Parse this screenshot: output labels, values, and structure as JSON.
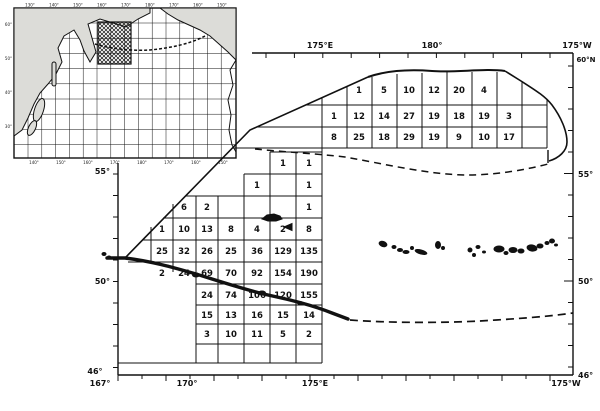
{
  "figure": {
    "kind": "survey-grid-map",
    "region_note": "",
    "colors": {
      "ink": "#111111",
      "paper": "#ffffff",
      "land_fill": "#dcdcd8"
    }
  },
  "axes": {
    "top_labels": [
      {
        "text": "175°E",
        "x": 320
      },
      {
        "text": "180°",
        "x": 432
      },
      {
        "text": "175°W",
        "x": 577
      }
    ],
    "corner_label": {
      "text": "60°N",
      "x": 586,
      "y": 62
    },
    "right_labels": [
      {
        "text": "55°",
        "y": 177
      },
      {
        "text": "50°",
        "y": 284
      },
      {
        "text": "46°",
        "y": 378
      }
    ],
    "left_labels": [
      {
        "text": "55°",
        "y": 174
      },
      {
        "text": "50°",
        "y": 284
      }
    ],
    "bottom_left_label": {
      "text": "46°",
      "x": 95,
      "y": 374
    },
    "bottom_labels": [
      {
        "text": "167°",
        "x": 100
      },
      {
        "text": "170°",
        "x": 187
      },
      {
        "text": "175°E",
        "x": 315
      },
      {
        "text": "175°W",
        "x": 566
      }
    ]
  },
  "inset": {
    "top_labels": [
      "130°",
      "140°",
      "150°",
      "160°",
      "170°",
      "180°",
      "170°",
      "160°",
      "150°"
    ],
    "bottom_labels": [
      "140°",
      "150°",
      "160°",
      "170°",
      "180°",
      "170°",
      "160°",
      "150°"
    ],
    "left_labels": [
      "60°",
      "50°",
      "40°",
      "30°"
    ]
  },
  "chart_data": {
    "type": "table",
    "title": "",
    "upper_block": {
      "note": "eastern Bering Sea shelf grid, 3 rows x 9 columns",
      "rows": [
        [
          "",
          "1",
          "5",
          "10",
          "12",
          "20",
          "4",
          "",
          ""
        ],
        [
          "1",
          "12",
          "14",
          "27",
          "19",
          "18",
          "19",
          "3",
          ""
        ],
        [
          "8",
          "25",
          "18",
          "29",
          "19",
          "9",
          "10",
          "17",
          ""
        ]
      ]
    },
    "left_block": {
      "note": "western Aleutian grid, 10 rows x 8 columns",
      "rows": [
        [
          "",
          "",
          "",
          "",
          "",
          "",
          "1",
          "1"
        ],
        [
          "",
          "",
          "",
          "",
          "",
          "1",
          "",
          "1"
        ],
        [
          "",
          "",
          "6",
          "2",
          "",
          "",
          "",
          "1"
        ],
        [
          "",
          "1",
          "10",
          "13",
          "8",
          "4",
          "2",
          "8"
        ],
        [
          "",
          "25",
          "32",
          "26",
          "25",
          "36",
          "129",
          "135"
        ],
        [
          "",
          "2",
          "24",
          "69",
          "70",
          "92",
          "154",
          "190"
        ],
        [
          "",
          "",
          "",
          "24",
          "74",
          "106",
          "120",
          "155"
        ],
        [
          "",
          "",
          "",
          "15",
          "13",
          "16",
          "15",
          "14"
        ],
        [
          "",
          "",
          "",
          "3",
          "10",
          "11",
          "5",
          "2"
        ],
        [
          "",
          "",
          "",
          "",
          "",
          "",
          "",
          ""
        ]
      ]
    }
  }
}
